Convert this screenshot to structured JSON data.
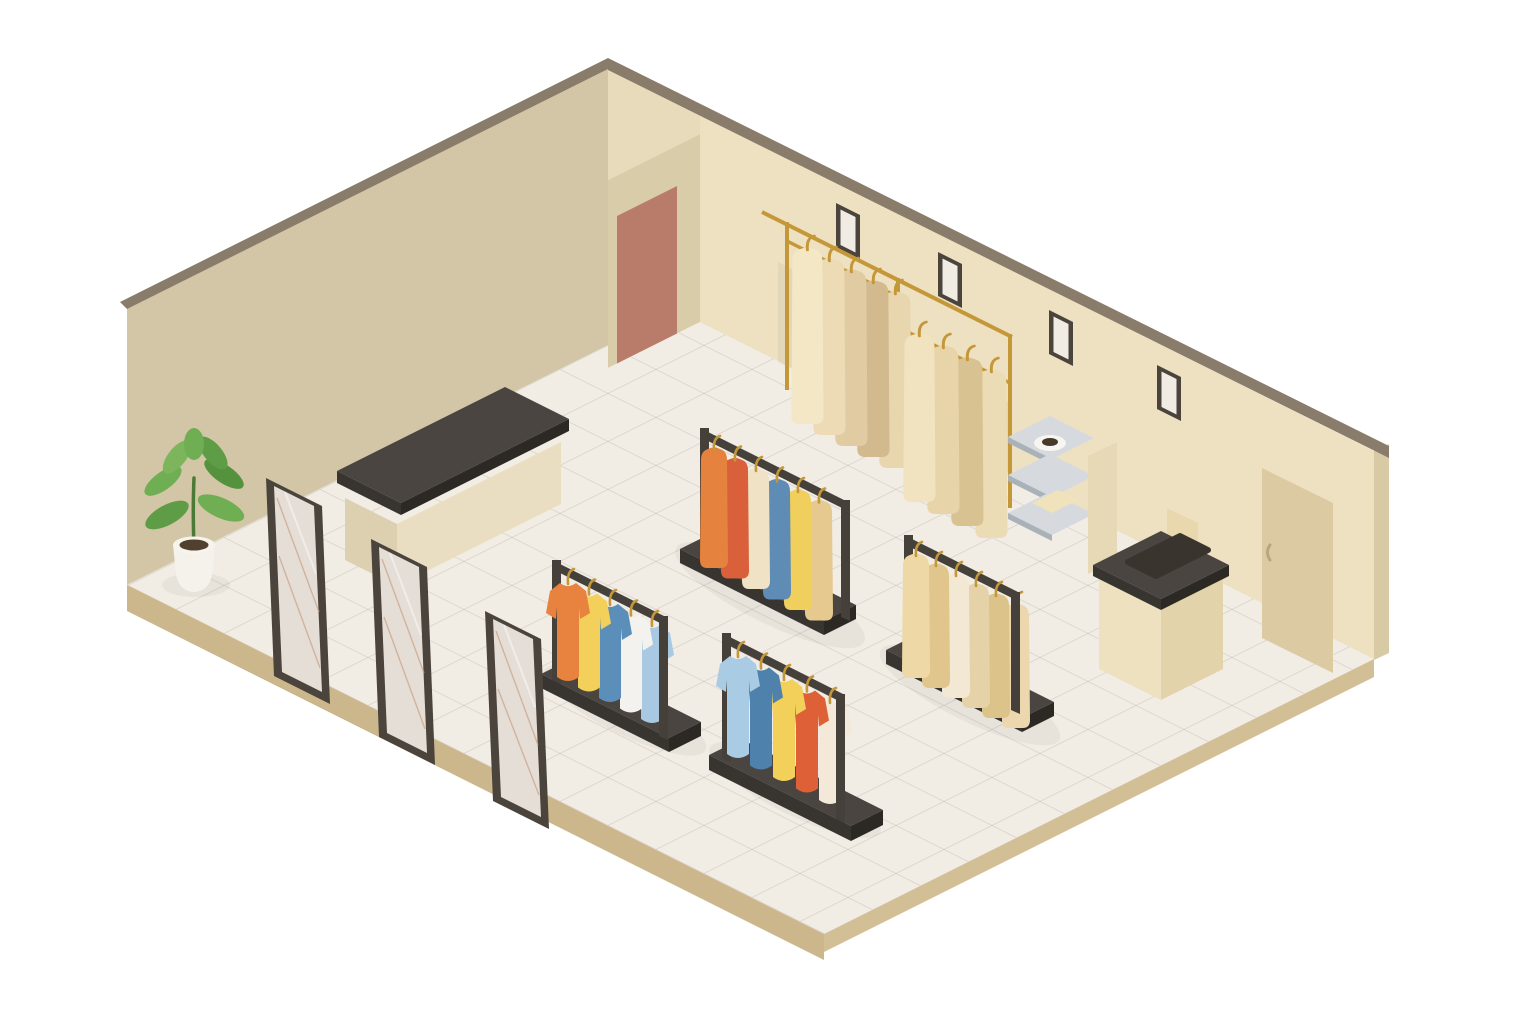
{
  "scene": {
    "description": "Isometric illustration of a clothing store interior with tiled floor, two beige walls, a red door, a tan door, four picture frames, a gold wall rail with hanging beige garments, a metal display shelf with a bowl and folded cloth, a checkout counter with a card stand, a dark-topped display table, three leaning mirrors, a potted plant and four freestanding clothing racks"
  },
  "counts": {
    "clothing_racks": 4,
    "mirrors": 3,
    "picture_frames": 4,
    "doors": 2,
    "plants": 1
  },
  "colors": {
    "background": "#ffffff",
    "wall_left": "#d3c6a6",
    "wall_right": "#eee1c1",
    "wall_nook_side": "#e8dbbc",
    "wall_nook_face": "#d9cca9",
    "wall_top_edge": "#8a7c6a",
    "wall_right_side": "#d9caa6",
    "door_left": "#b97b6a",
    "door_right": "#dccaa2",
    "door_handle": "#b9a67e",
    "floor_tile": "#f1ece4",
    "tile_grout": "#d5d0c7",
    "floor_edge_left": "#ccb78d",
    "floor_edge_right": "#d3bf96",
    "dark": "#454039",
    "dark_top": "#4a4540",
    "dark_side": "#38342f",
    "dark_side2": "#2c2925",
    "gold": "#c49738",
    "frame_border": "#4b443c",
    "frame_mat": "#f0ebe3",
    "mirror_glass": "#f2ece4",
    "mirror_line": "#c9a183",
    "cream_face": "#e9dec1",
    "cream_face_dark": "#ddd0b0",
    "checkout_left": "#eee1c0",
    "checkout_right": "#e2d3ab",
    "checkout_card": "#e9d7ae",
    "tray_dark": "#39342e",
    "shelf_metal": "#d6dade",
    "shelf_metal_edge": "#a9b1b9",
    "bowl": "#f7f5f1",
    "bowl_inner": "#46392a",
    "towel": "#f0e2ba",
    "panel": "#e7d9b6",
    "pot": "#f5f2ec",
    "pot_rim": "#f7f4ee",
    "soil": "#52402e",
    "stem": "#4a7a35",
    "leaf_1": "#5f9c46",
    "leaf_2": "#6fae52",
    "leaf_3": "#54923e",
    "leaf_4": "#7db55c",
    "shadow": "#2f2a24"
  },
  "wall_rail": {
    "left_garments": [
      "#f4e7c6",
      "#ecdbb4",
      "#e0cba2",
      "#d2b98e",
      "#e8d6ae"
    ],
    "right_garments": [
      "#f1e3bf",
      "#e7d4a9",
      "#d9c291",
      "#ecdcb6"
    ]
  },
  "racks": {
    "long_back": [
      "#e5823e",
      "#d9603a",
      "#f0e2c4",
      "#5e8cb5",
      "#f1cf5c",
      "#e5c98f"
    ],
    "tees_left": [
      "#e8823f",
      "#f2d05a",
      "#5b8fb9",
      "#f4f2ee",
      "#a9c9e2"
    ],
    "tees_front": [
      "#a9cbe4",
      "#4f81ad",
      "#f2d05a",
      "#dd6036",
      "#f4e9d9"
    ],
    "beige_right": [
      "#eed9a6",
      "#e0c68c",
      "#f2e8d4",
      "#e6d2a8",
      "#dcc389",
      "#ecd7ae"
    ]
  }
}
